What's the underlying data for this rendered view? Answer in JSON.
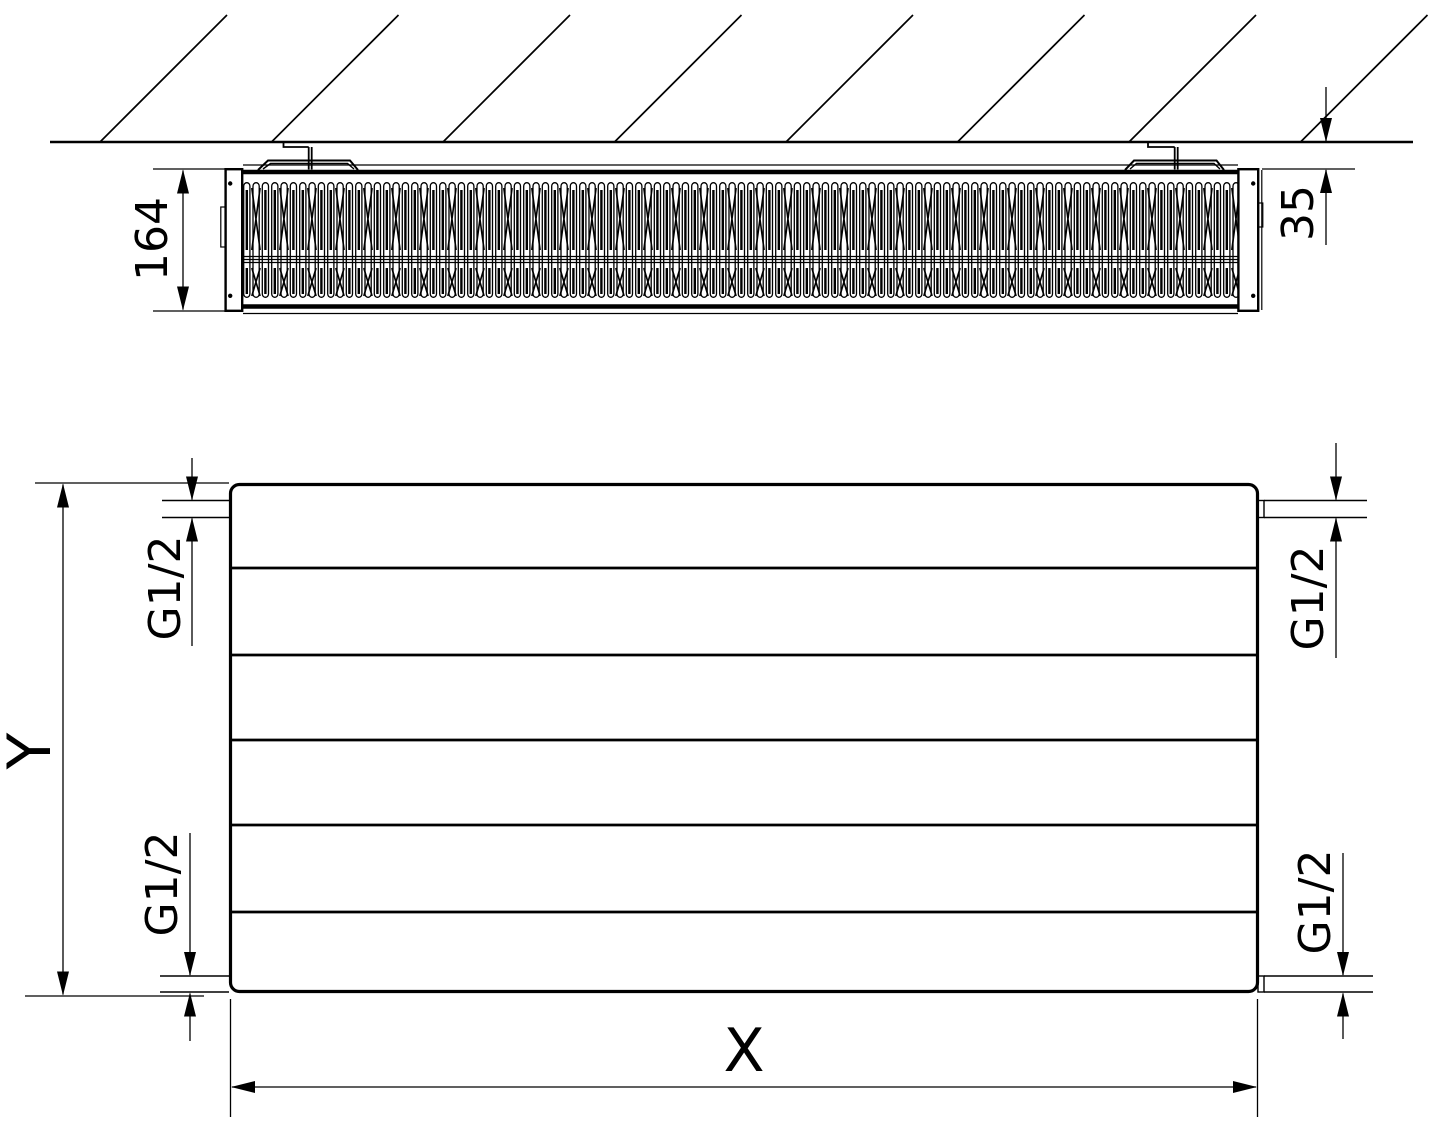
{
  "colors": {
    "line": "#000000",
    "background": "#ffffff"
  },
  "section_view": {
    "depth_mm": "164",
    "wall_gap_mm": "35"
  },
  "front_view": {
    "height_label": "Y",
    "length_label": "X",
    "thread_labels": {
      "top_left": "G1/2",
      "top_right": "G1/2",
      "bottom_left": "G1/2",
      "bottom_right": "G1/2"
    }
  }
}
